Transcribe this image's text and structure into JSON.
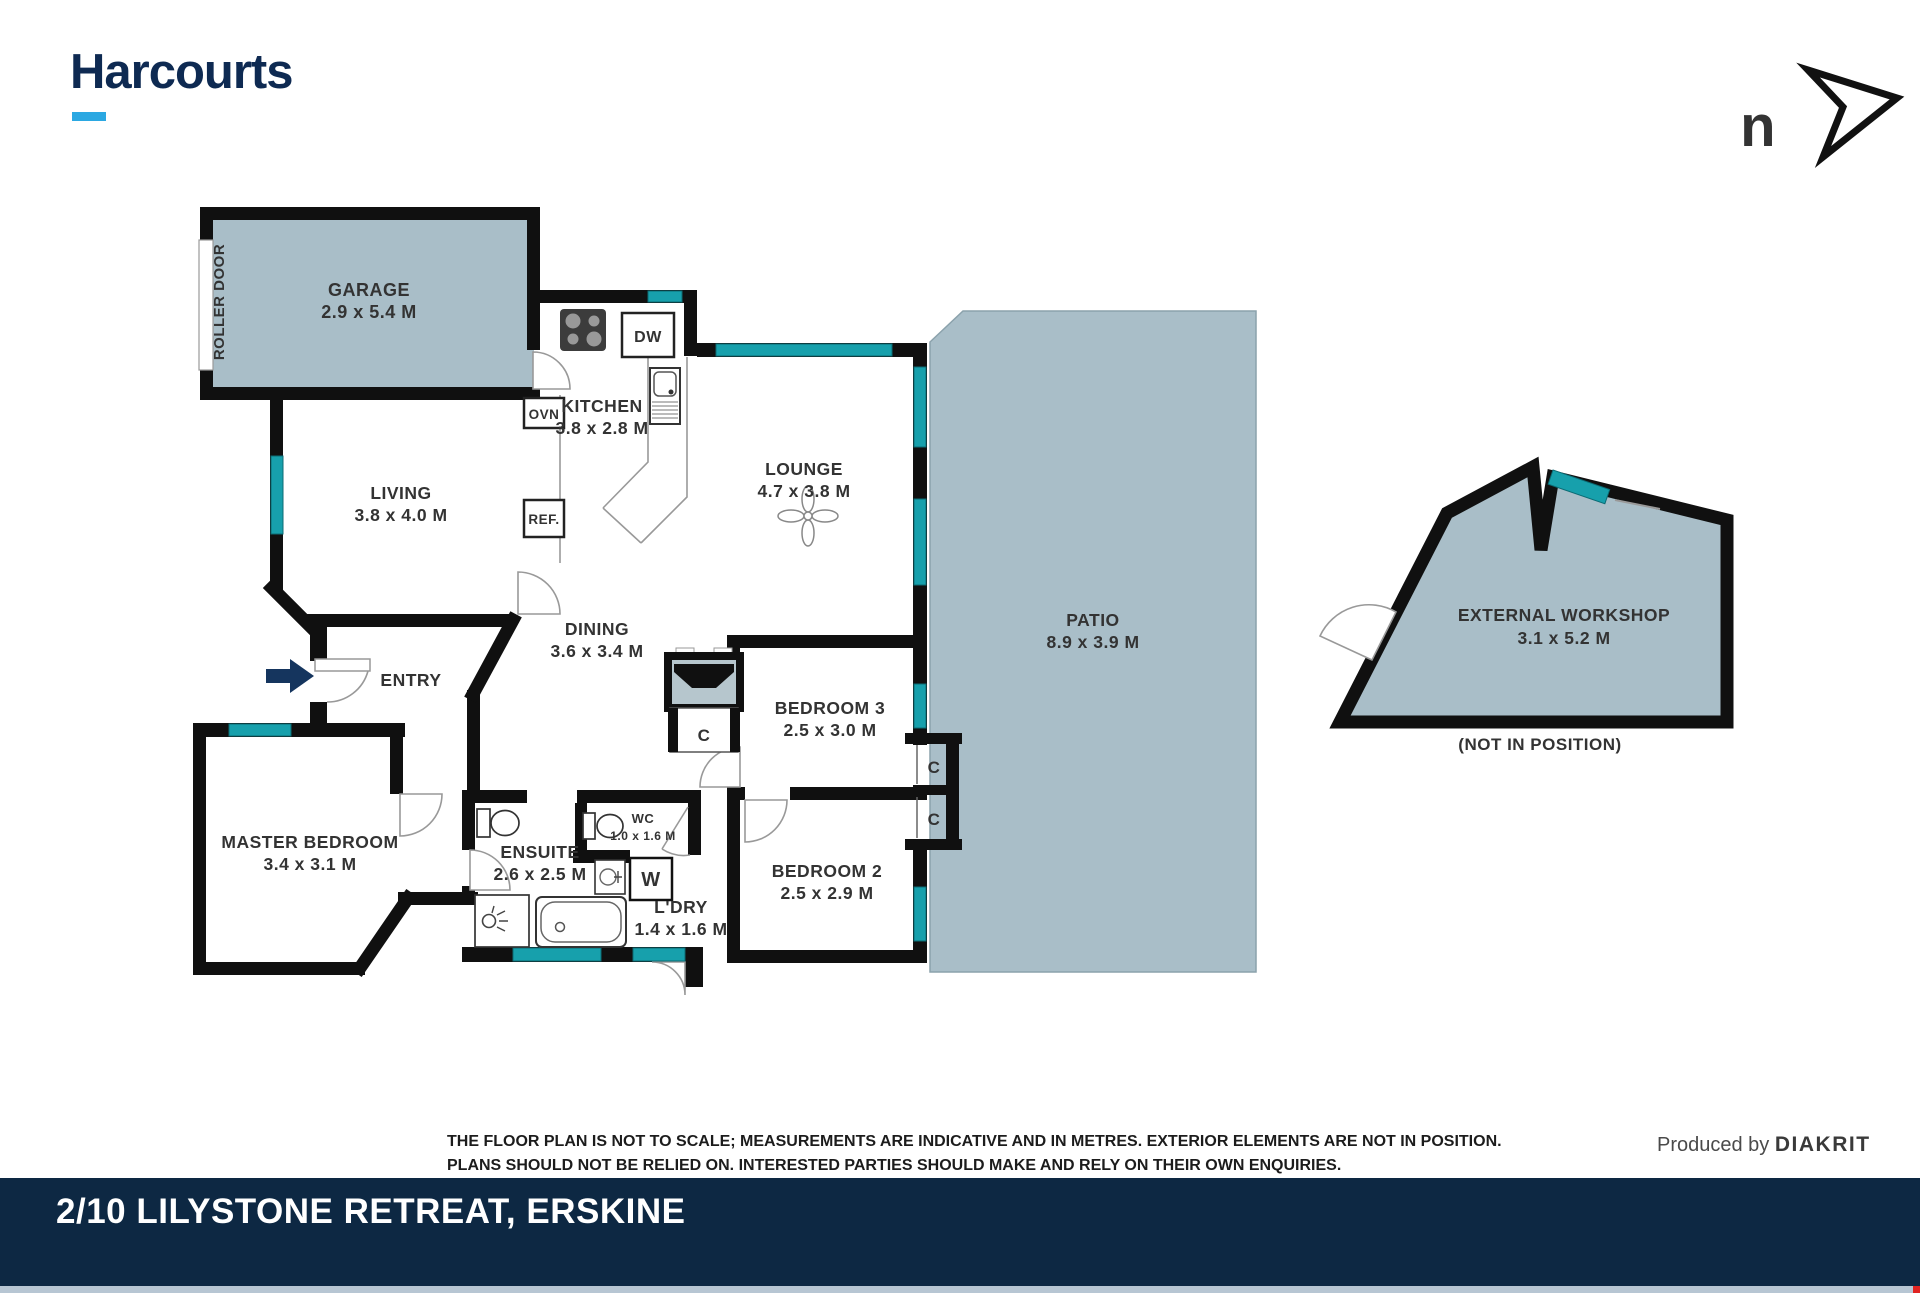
{
  "header": {
    "brand": "Harcourts",
    "north_indicator": "n"
  },
  "plan": {
    "rooms": [
      {
        "name": "GARAGE",
        "dims": "2.9 x 5.4 M"
      },
      {
        "name": "KITCHEN",
        "dims": "3.8 x 2.8 M"
      },
      {
        "name": "LIVING",
        "dims": "3.8 x 4.0 M"
      },
      {
        "name": "LOUNGE",
        "dims": "4.7 x 3.8 M"
      },
      {
        "name": "DINING",
        "dims": "3.6 x 3.4 M"
      },
      {
        "name": "PATIO",
        "dims": "8.9 x 3.9 M"
      },
      {
        "name": "BEDROOM 3",
        "dims": "2.5 x 3.0 M"
      },
      {
        "name": "BEDROOM 2",
        "dims": "2.5 x 2.9 M"
      },
      {
        "name": "MASTER BEDROOM",
        "dims": "3.4 x 3.1 M"
      },
      {
        "name": "ENSUITE",
        "dims": "2.6 x 2.5 M"
      },
      {
        "name": "WC",
        "dims": "1.0 x 1.6 M"
      },
      {
        "name": "L'DRY",
        "dims": "1.4 x 1.6 M"
      },
      {
        "name": "EXTERNAL WORKSHOP",
        "dims": "3.1 x 5.2 M"
      }
    ],
    "labels": {
      "roller_door": "ROLLER DOOR",
      "entry": "ENTRY",
      "dw": "DW",
      "ovn": "OVN",
      "ref": "REF.",
      "w": "W",
      "closet": "C",
      "not_in_position": "(NOT IN POSITION)"
    }
  },
  "footer": {
    "disclaimer_line1": "THE FLOOR PLAN IS NOT TO SCALE; MEASUREMENTS ARE INDICATIVE AND IN METRES. EXTERIOR ELEMENTS ARE NOT IN POSITION.",
    "disclaimer_line2": "PLANS SHOULD NOT BE RELIED ON. INTERESTED PARTIES SHOULD MAKE AND RELY ON THEIR OWN ENQUIRIES.",
    "produced_by": "Produced by",
    "producer": "DIAKRIT",
    "address": "2/10 LILYSTONE RETREAT, ERSKINE"
  },
  "colors": {
    "brand_navy": "#0e2a52",
    "accent_cyan": "#2ba8e2",
    "wall_black": "#101010",
    "area_fill": "#a9bec8",
    "window_teal": "#17a0ac",
    "bar_navy": "#0d2843"
  }
}
